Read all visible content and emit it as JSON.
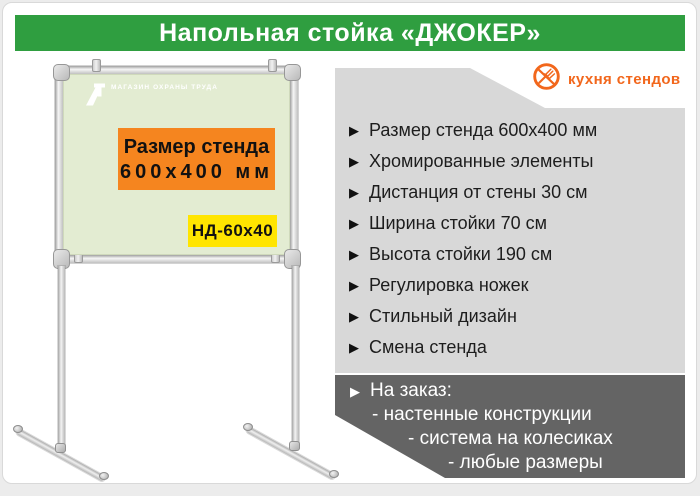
{
  "header": {
    "title": "Напольная стойка «ДЖОКЕР»",
    "bg_color": "#2f9e40"
  },
  "brand": {
    "name": "кухня стендов",
    "color": "#f2671c",
    "icon": "crossed-fork-icon"
  },
  "icons": {
    "bullet": "▶"
  },
  "board": {
    "bg_color": "#e3ecd2",
    "shop_logo_text": "МАГАЗИН ОХРАНЫ ТРУДА",
    "size_box": {
      "line1": "Размер стенда",
      "line2": "600х400 мм",
      "bg_color": "#f5851f"
    },
    "model_badge": {
      "label": "НД-60х40",
      "bg_color": "#ffe500"
    }
  },
  "features": {
    "bg_color": "#d8d8d8",
    "items": [
      "Размер стенда 600х400 мм",
      "Хромированные элементы",
      "Дистанция от стены 30 см",
      "Ширина стойки 70 см",
      "Высота стойки 190 см",
      "Регулировка ножек",
      "Стильный дизайн",
      "Смена стенда"
    ]
  },
  "order_box": {
    "bg_color": "#646464",
    "title": "На заказ:",
    "lines": [
      "- настенные конструкции",
      "- система на колесиках",
      "- любые размеры"
    ]
  }
}
